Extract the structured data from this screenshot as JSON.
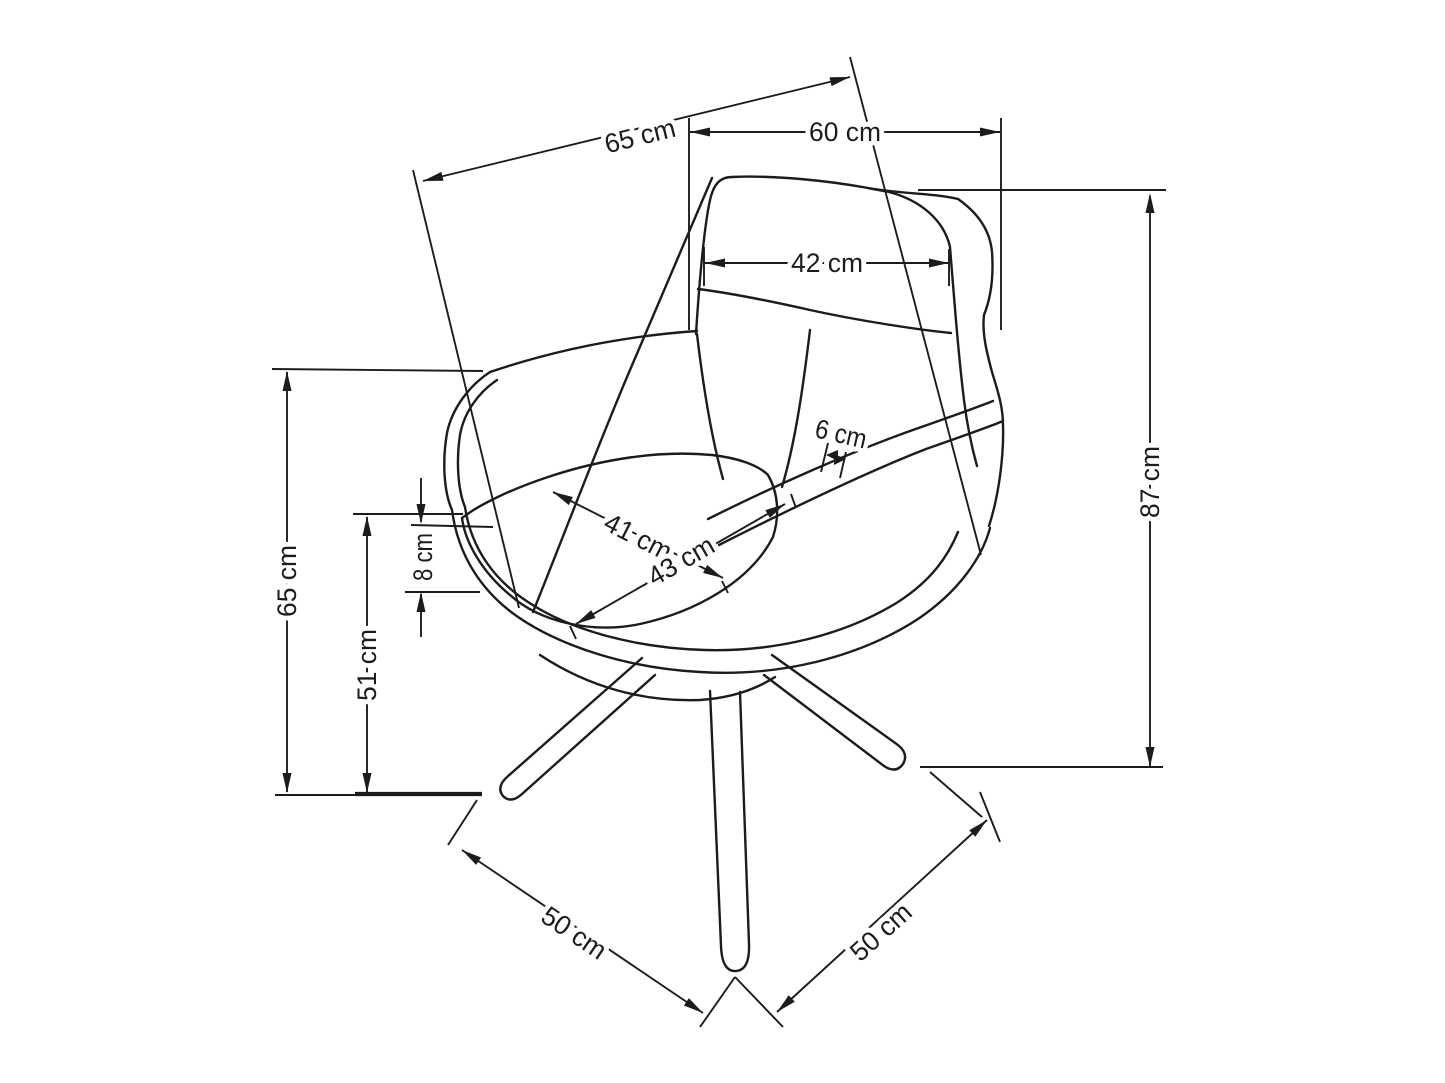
{
  "diagram": {
    "type": "furniture-dimension-drawing",
    "subject": "armchair",
    "unit": "cm",
    "colors": {
      "line": "#1c1c1c",
      "background": "#ffffff"
    },
    "dimensions": [
      {
        "id": "overall-width-diagonal",
        "value": 65,
        "label": "65 cm"
      },
      {
        "id": "overall-depth-top",
        "value": 60,
        "label": "60 cm"
      },
      {
        "id": "backrest-width",
        "value": 42,
        "label": "42 cm"
      },
      {
        "id": "overall-height",
        "value": 87,
        "label": "87 cm"
      },
      {
        "id": "armrest-height",
        "value": 65,
        "label": "65 cm"
      },
      {
        "id": "seat-height",
        "value": 51,
        "label": "51 cm"
      },
      {
        "id": "seat-shell-thickness",
        "value": 8,
        "label": "8 cm"
      },
      {
        "id": "seat-width",
        "value": 41,
        "label": "41 cm"
      },
      {
        "id": "seat-depth",
        "value": 43,
        "label": "43 cm"
      },
      {
        "id": "armrest-top-width",
        "value": 6,
        "label": "6 cm"
      },
      {
        "id": "base-span-left",
        "value": 50,
        "label": "50 cm"
      },
      {
        "id": "base-span-right",
        "value": 50,
        "label": "50 cm"
      }
    ]
  }
}
